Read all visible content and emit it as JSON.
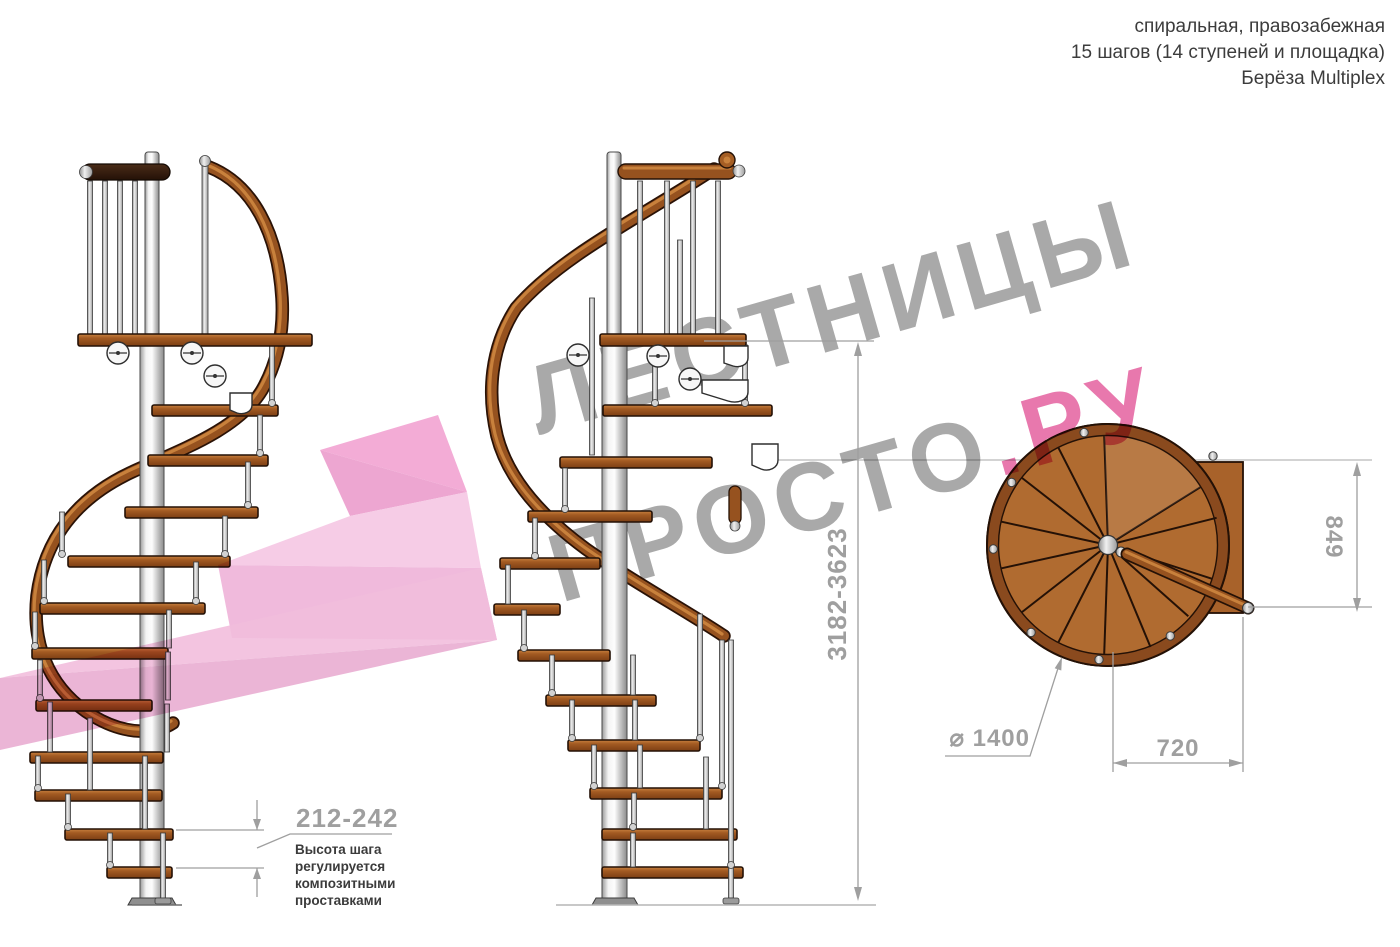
{
  "header": {
    "line1": "спиральная, правозабежная",
    "line2": "15 шагов (14 ступеней и площадка)",
    "line3": "Берёза Multiplex"
  },
  "watermark": {
    "word1": "ЛЕСТНИЦЫ",
    "word2": "ПРОСТО",
    "word2_suffix": ".РУ"
  },
  "dimensions": {
    "total_height": "3182-3623",
    "step_height": "212-242",
    "plan_depth": "849",
    "plan_width": "720",
    "plan_diameter": "⌀ 1400"
  },
  "annotation": {
    "line1": "Высота шага",
    "line2": "регулируется",
    "line3": "композитными",
    "line4": "проставками"
  },
  "palette": {
    "accent_pink": "#e878ad",
    "arrow_pink": "#eeb2d8",
    "watermark_gray": "#a9a9a9",
    "dimension_gray": "#9f9f9f",
    "text_dark": "#3c3c3c",
    "wood_brown": "#96521f",
    "metal_silver": "#d9d9d9"
  }
}
